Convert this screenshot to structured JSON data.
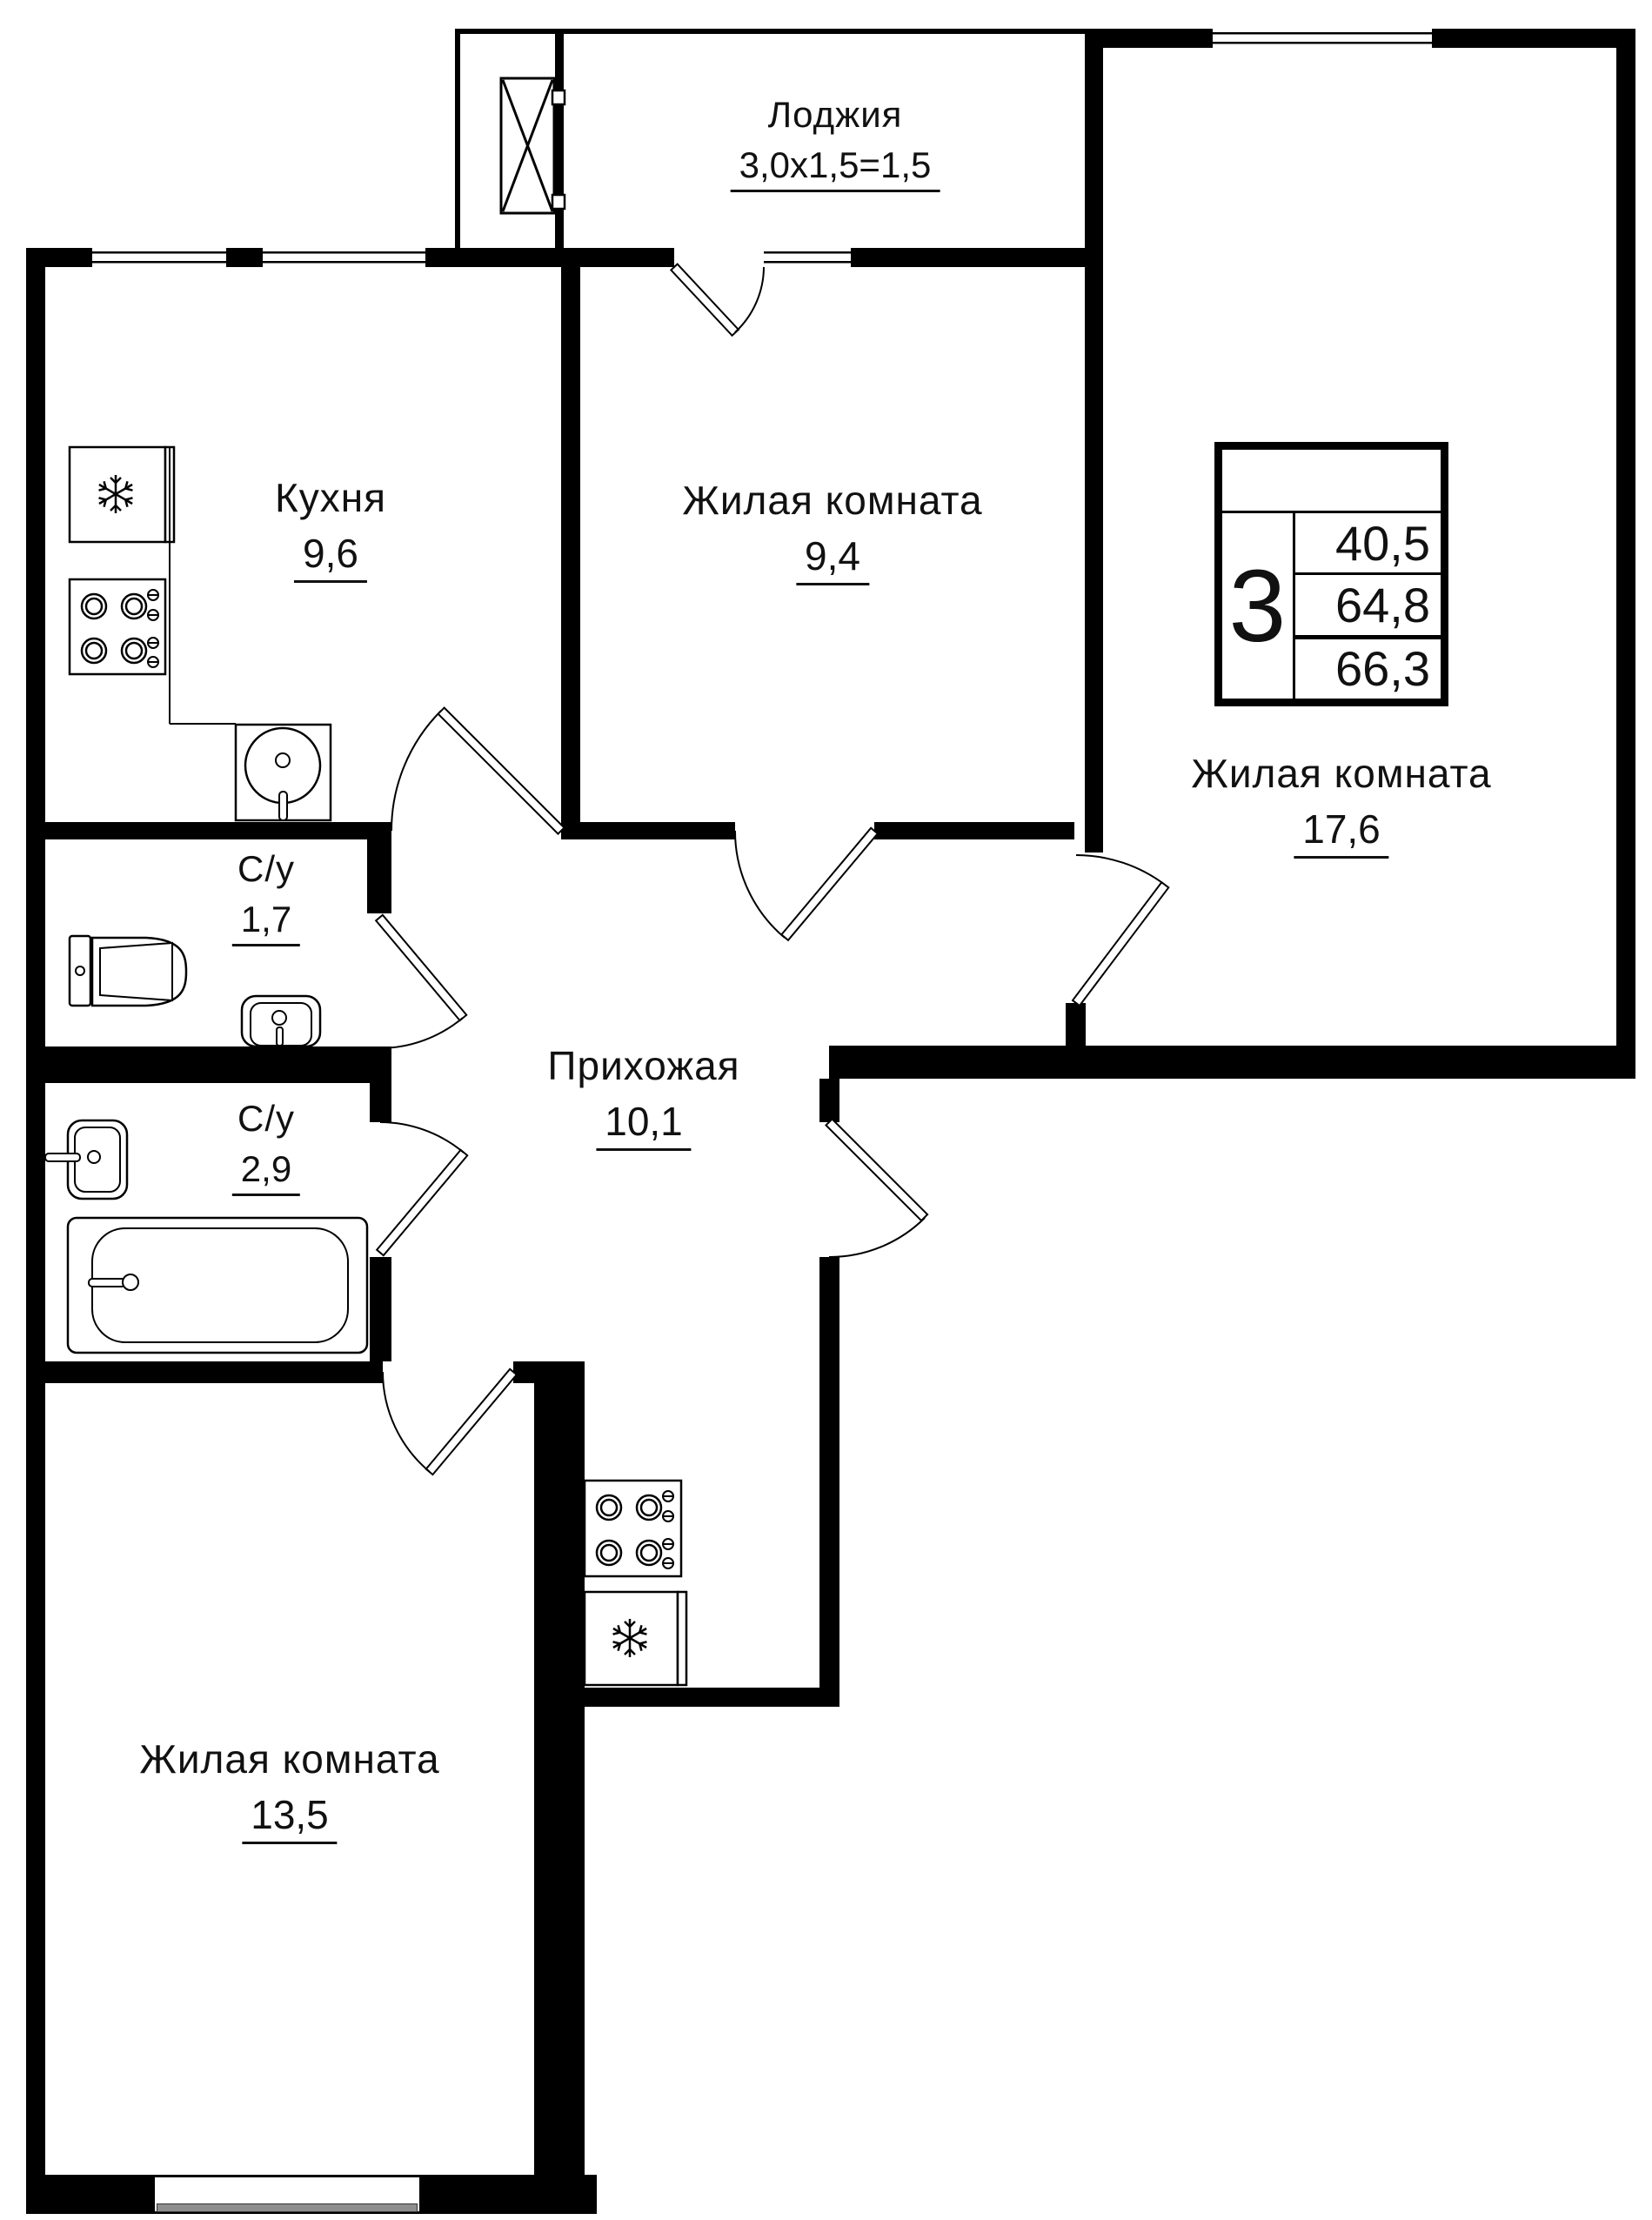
{
  "colors": {
    "wall": "#000000",
    "background": "#ffffff",
    "text": "#111111",
    "window_sill": "#8e8e8e"
  },
  "rooms": {
    "loggia": {
      "name": "Лоджия",
      "area": "3,0х1,5=1,5"
    },
    "kitchen": {
      "name": "Кухня",
      "area": "9,6"
    },
    "living_top": {
      "name": "Жилая комната",
      "area": "9,4"
    },
    "living_right": {
      "name": "Жилая комната",
      "area": "17,6"
    },
    "wc_small": {
      "name": "С/у",
      "area": "1,7"
    },
    "wc_big": {
      "name": "С/у",
      "area": "2,9"
    },
    "hallway": {
      "name": "Прихожая",
      "area": "10,1"
    },
    "living_bottom": {
      "name": "Жилая комната",
      "area": "13,5"
    }
  },
  "stats": {
    "room_count": "3",
    "living_area": "40,5",
    "area_without_loggia": "64,8",
    "total_area": "66,3"
  }
}
